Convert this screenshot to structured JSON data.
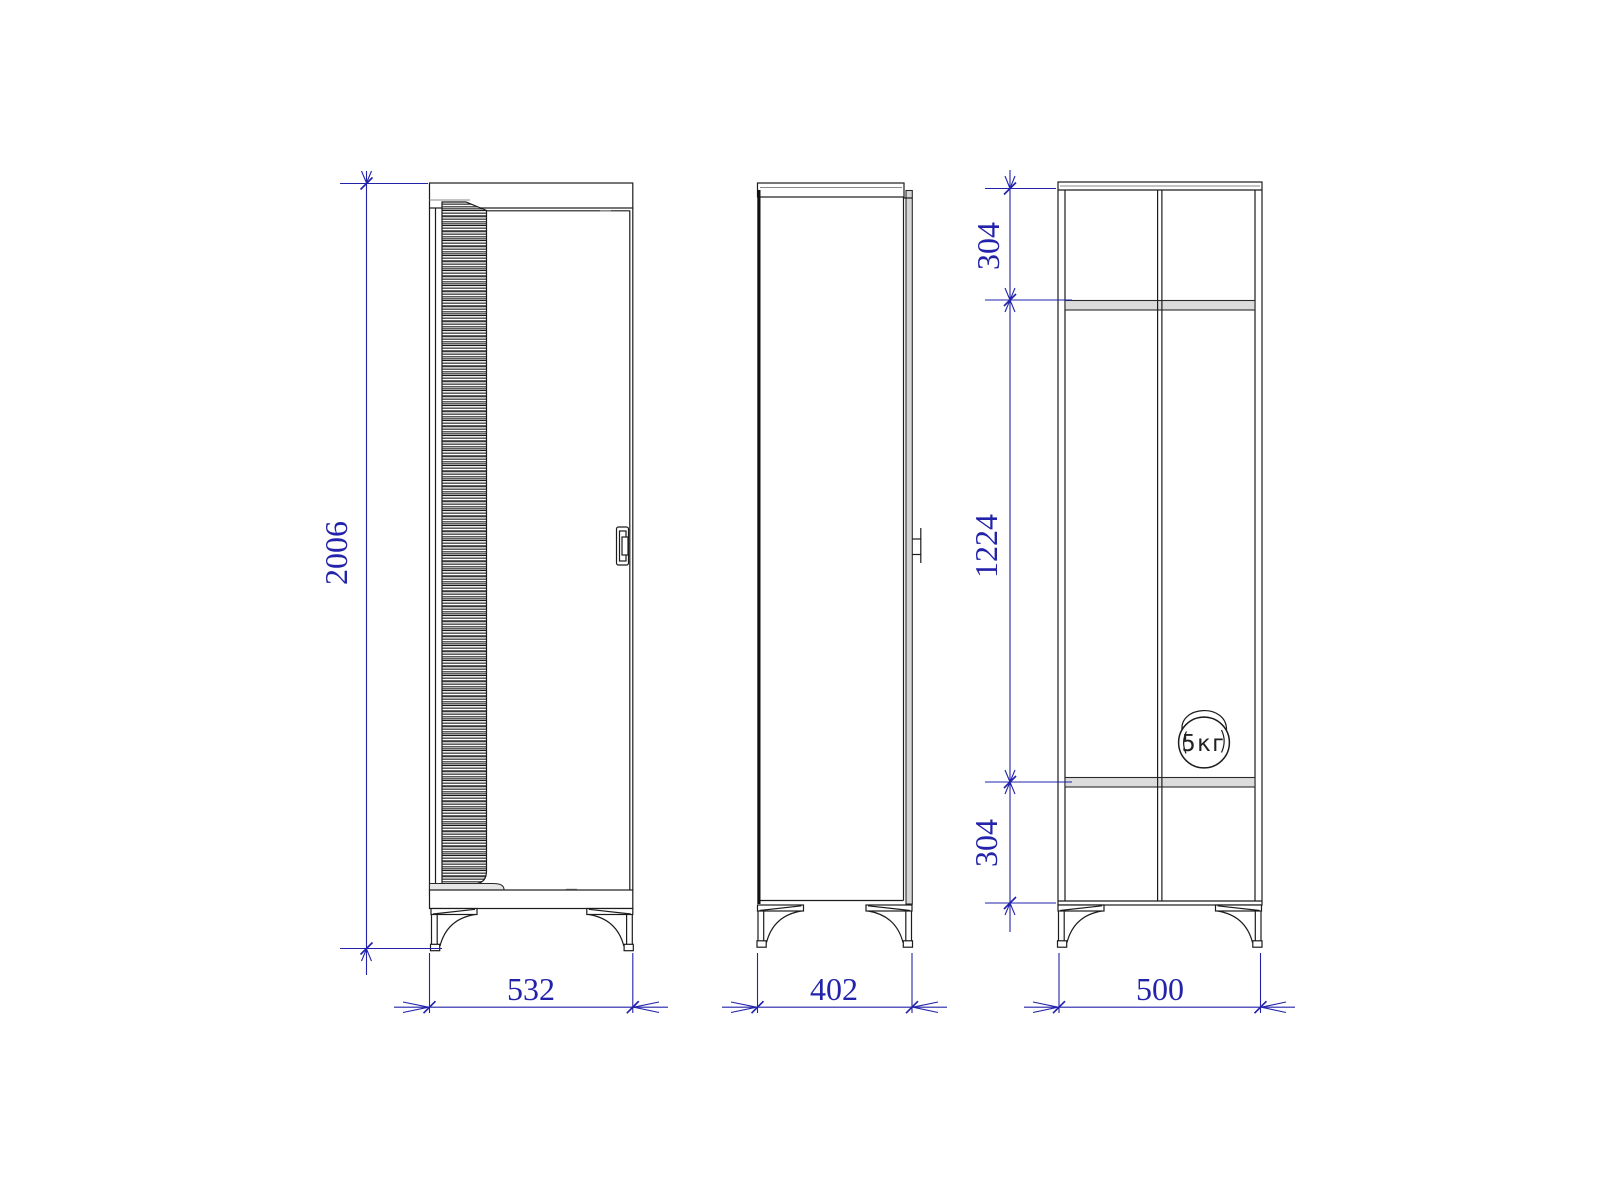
{
  "drawing": {
    "title": "wardrobe-three-view-technical-drawing",
    "dimensions": {
      "overall_height": "2006",
      "front_width": "532",
      "side_depth": "402",
      "section_width": "500",
      "section_top": "304",
      "section_middle": "1224",
      "section_bottom": "304"
    },
    "labels": {
      "max_load": "5кг"
    },
    "colors": {
      "dimension": "#2222aa",
      "line": "#1c1c1c",
      "background": "#ffffff"
    }
  }
}
